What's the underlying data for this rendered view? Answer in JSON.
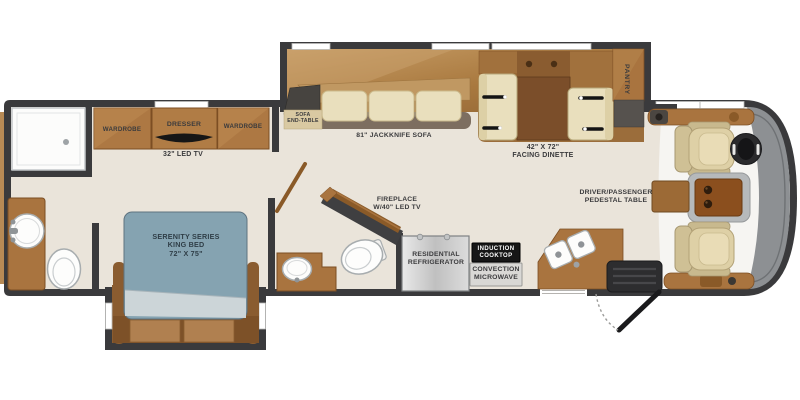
{
  "meta": {
    "type": "rv-motorhome-floorplan"
  },
  "colors": {
    "wall": "#3a3a3c",
    "floor": "#eae4da",
    "cabinet_wood": "#a9743f",
    "slideout_wood": "#b08a54",
    "bed_blue": "#85a3b1",
    "front_cap_gray": "#8d9093",
    "cooktop_black": "#161616"
  },
  "areas": {
    "bedroom": {
      "wardrobe_left": "WARDROBE",
      "dresser": "DRESSER",
      "wardrobe_right": "WARDROBE",
      "tv": "32\" LED TV",
      "bed_line1": "SERENITY SERIES",
      "bed_line2": "KING BED",
      "bed_line3": "72\" X 75\""
    },
    "living": {
      "sofa_end_table_line1": "SOFA",
      "sofa_end_table_line2": "END-TABLE",
      "sofa": "81\" JACKKNIFE SOFA",
      "dinette_line1": "42\" X 72\"",
      "dinette_line2": "FACING DINETTE",
      "fireplace_line1": "FIREPLACE",
      "fireplace_line2": "W/40\" LED TV"
    },
    "kitchen": {
      "pantry": "PANTRY",
      "refrigerator_line1": "RESIDENTIAL",
      "refrigerator_line2": "REFRIGERATOR",
      "cooktop_line1": "INDUCTION",
      "cooktop_line2": "COOKTOP",
      "microwave_line1": "CONVECTION",
      "microwave_line2": "MICROWAVE"
    },
    "cockpit": {
      "pedestal_line1": "DRIVER/PASSENGER",
      "pedestal_line2": "PEDESTAL TABLE"
    }
  }
}
